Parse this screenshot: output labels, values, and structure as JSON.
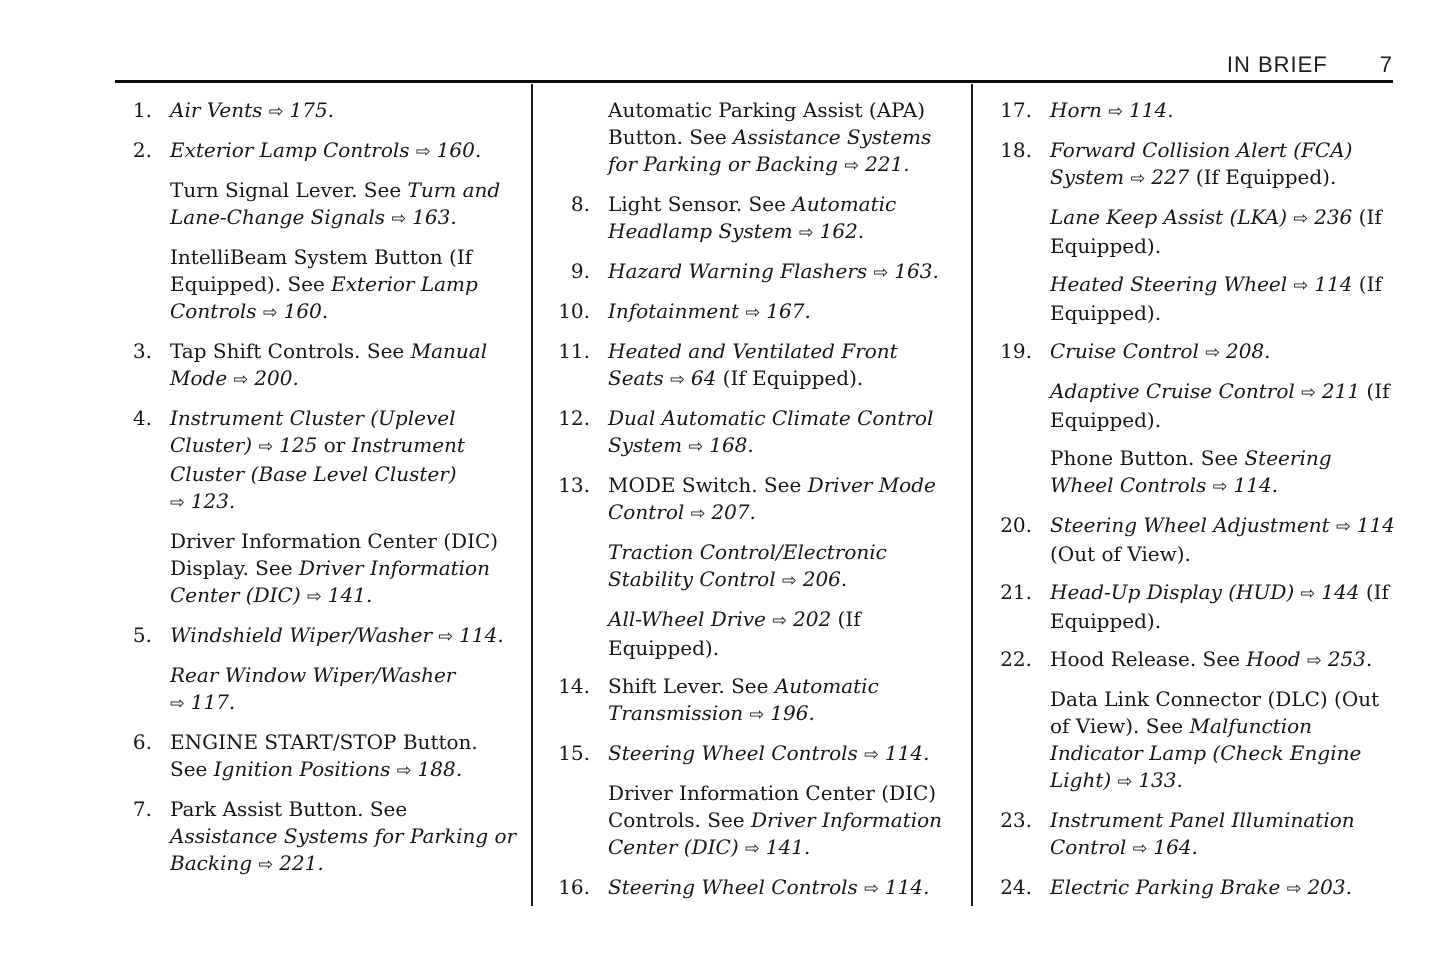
{
  "header": {
    "title": "IN BRIEF",
    "page_number": "7"
  },
  "symbols": {
    "arrow": "⇨"
  },
  "columns": [
    {
      "items": [
        {
          "number": "1.",
          "paragraphs": [
            {
              "runs": [
                {
                  "t": "Air Vents ",
                  "s": "i"
                },
                {
                  "ref": "175."
                }
              ]
            }
          ]
        },
        {
          "number": "2.",
          "paragraphs": [
            {
              "runs": [
                {
                  "t": "Exterior Lamp Controls ",
                  "s": "i"
                },
                {
                  "ref": "160."
                }
              ]
            },
            {
              "runs": [
                {
                  "t": "Turn Signal Lever. See ",
                  "s": "r"
                },
                {
                  "t": "Turn and Lane-Change Signals ",
                  "s": "i"
                },
                {
                  "ref": "163."
                }
              ]
            },
            {
              "runs": [
                {
                  "t": "IntelliBeam System Button (If Equipped). See ",
                  "s": "r"
                },
                {
                  "t": "Exterior Lamp Controls ",
                  "s": "i"
                },
                {
                  "ref": "160."
                }
              ]
            }
          ]
        },
        {
          "number": "3.",
          "paragraphs": [
            {
              "runs": [
                {
                  "t": "Tap Shift Controls. See ",
                  "s": "r"
                },
                {
                  "t": "Manual Mode ",
                  "s": "i"
                },
                {
                  "ref": "200."
                }
              ]
            }
          ]
        },
        {
          "number": "4.",
          "paragraphs": [
            {
              "runs": [
                {
                  "t": "Instrument Cluster (Uplevel Cluster) ",
                  "s": "i"
                },
                {
                  "ref": "125"
                },
                {
                  "t": " or ",
                  "s": "r"
                },
                {
                  "t": "Instrument Cluster (Base Level Cluster) ",
                  "s": "i"
                },
                {
                  "ref": "123."
                }
              ]
            },
            {
              "runs": [
                {
                  "t": "Driver Information Center (DIC) Display. See ",
                  "s": "r"
                },
                {
                  "t": "Driver Information Center (DIC) ",
                  "s": "i"
                },
                {
                  "ref": "141."
                }
              ]
            }
          ]
        },
        {
          "number": "5.",
          "paragraphs": [
            {
              "runs": [
                {
                  "t": "Windshield Wiper/Washer ",
                  "s": "i"
                },
                {
                  "ref": "114."
                }
              ]
            },
            {
              "runs": [
                {
                  "t": "Rear Window Wiper/Washer ",
                  "s": "i"
                },
                {
                  "ref": "117."
                }
              ]
            }
          ]
        },
        {
          "number": "6.",
          "paragraphs": [
            {
              "runs": [
                {
                  "t": "ENGINE START/STOP Button. See ",
                  "s": "r"
                },
                {
                  "t": "Ignition Positions ",
                  "s": "i"
                },
                {
                  "ref": "188."
                }
              ]
            }
          ]
        },
        {
          "number": "7.",
          "paragraphs": [
            {
              "runs": [
                {
                  "t": "Park Assist Button. See ",
                  "s": "r"
                },
                {
                  "t": "Assistance Systems for Parking or Backing ",
                  "s": "i"
                },
                {
                  "ref": "221."
                }
              ]
            }
          ]
        }
      ]
    },
    {
      "items": [
        {
          "number": null,
          "paragraphs": [
            {
              "runs": [
                {
                  "t": "Automatic Parking Assist (APA) Button. See ",
                  "s": "r"
                },
                {
                  "t": "Assistance Systems for Parking or Backing ",
                  "s": "i"
                },
                {
                  "ref": "221."
                }
              ]
            }
          ]
        },
        {
          "number": "8.",
          "paragraphs": [
            {
              "runs": [
                {
                  "t": "Light Sensor. See ",
                  "s": "r"
                },
                {
                  "t": "Automatic Headlamp System ",
                  "s": "i"
                },
                {
                  "ref": "162."
                }
              ]
            }
          ]
        },
        {
          "number": "9.",
          "paragraphs": [
            {
              "runs": [
                {
                  "t": "Hazard Warning Flashers ",
                  "s": "i"
                },
                {
                  "ref": "163."
                }
              ]
            }
          ]
        },
        {
          "number": "10.",
          "paragraphs": [
            {
              "runs": [
                {
                  "t": "Infotainment ",
                  "s": "i"
                },
                {
                  "ref": "167."
                }
              ]
            }
          ]
        },
        {
          "number": "11.",
          "paragraphs": [
            {
              "runs": [
                {
                  "t": "Heated and Ventilated Front Seats ",
                  "s": "i"
                },
                {
                  "ref": "64"
                },
                {
                  "t": " (If Equipped).",
                  "s": "r"
                }
              ]
            }
          ]
        },
        {
          "number": "12.",
          "paragraphs": [
            {
              "runs": [
                {
                  "t": "Dual Automatic Climate Control System ",
                  "s": "i"
                },
                {
                  "ref": "168."
                }
              ]
            }
          ]
        },
        {
          "number": "13.",
          "paragraphs": [
            {
              "runs": [
                {
                  "t": "MODE Switch. See ",
                  "s": "r"
                },
                {
                  "t": "Driver Mode Control ",
                  "s": "i"
                },
                {
                  "ref": "207."
                }
              ]
            },
            {
              "runs": [
                {
                  "t": "Traction Control/Electronic Stability Control ",
                  "s": "i"
                },
                {
                  "ref": "206."
                }
              ]
            },
            {
              "runs": [
                {
                  "t": "All-Wheel Drive ",
                  "s": "i"
                },
                {
                  "ref": "202"
                },
                {
                  "t": " (If Equipped).",
                  "s": "r"
                }
              ]
            }
          ]
        },
        {
          "number": "14.",
          "paragraphs": [
            {
              "runs": [
                {
                  "t": "Shift Lever. See ",
                  "s": "r"
                },
                {
                  "t": "Automatic Transmission ",
                  "s": "i"
                },
                {
                  "ref": "196."
                }
              ]
            }
          ]
        },
        {
          "number": "15.",
          "paragraphs": [
            {
              "runs": [
                {
                  "t": "Steering Wheel Controls ",
                  "s": "i"
                },
                {
                  "ref": "114."
                }
              ]
            },
            {
              "runs": [
                {
                  "t": "Driver Information Center (DIC) Controls. See ",
                  "s": "r"
                },
                {
                  "t": "Driver Information Center (DIC) ",
                  "s": "i"
                },
                {
                  "ref": "141."
                }
              ]
            }
          ]
        },
        {
          "number": "16.",
          "paragraphs": [
            {
              "runs": [
                {
                  "t": "Steering Wheel Controls ",
                  "s": "i"
                },
                {
                  "ref": "114."
                }
              ]
            }
          ]
        }
      ]
    },
    {
      "items": [
        {
          "number": "17.",
          "paragraphs": [
            {
              "runs": [
                {
                  "t": "Horn ",
                  "s": "i"
                },
                {
                  "ref": "114."
                }
              ]
            }
          ]
        },
        {
          "number": "18.",
          "paragraphs": [
            {
              "runs": [
                {
                  "t": "Forward Collision Alert (FCA) System ",
                  "s": "i"
                },
                {
                  "ref": "227"
                },
                {
                  "t": " (If Equipped).",
                  "s": "r"
                }
              ]
            },
            {
              "runs": [
                {
                  "t": "Lane Keep Assist (LKA) ",
                  "s": "i"
                },
                {
                  "ref": "236"
                },
                {
                  "t": " (If Equipped).",
                  "s": "r"
                }
              ]
            },
            {
              "runs": [
                {
                  "t": "Heated Steering Wheel ",
                  "s": "i"
                },
                {
                  "ref": "114"
                },
                {
                  "t": " (If Equipped).",
                  "s": "r"
                }
              ]
            }
          ]
        },
        {
          "number": "19.",
          "paragraphs": [
            {
              "runs": [
                {
                  "t": "Cruise Control ",
                  "s": "i"
                },
                {
                  "ref": "208."
                }
              ]
            },
            {
              "runs": [
                {
                  "t": "Adaptive Cruise Control ",
                  "s": "i"
                },
                {
                  "ref": "211"
                },
                {
                  "t": " (If Equipped).",
                  "s": "r"
                }
              ]
            },
            {
              "runs": [
                {
                  "t": "Phone Button. See ",
                  "s": "r"
                },
                {
                  "t": "Steering Wheel Controls ",
                  "s": "i"
                },
                {
                  "ref": "114."
                }
              ]
            }
          ]
        },
        {
          "number": "20.",
          "paragraphs": [
            {
              "runs": [
                {
                  "t": "Steering Wheel Adjustment ",
                  "s": "i"
                },
                {
                  "ref": "114"
                },
                {
                  "t": " (Out of View).",
                  "s": "r"
                }
              ]
            }
          ]
        },
        {
          "number": "21.",
          "paragraphs": [
            {
              "runs": [
                {
                  "t": "Head-Up Display (HUD) ",
                  "s": "i"
                },
                {
                  "ref": "144"
                },
                {
                  "t": " (If Equipped).",
                  "s": "r"
                }
              ]
            }
          ]
        },
        {
          "number": "22.",
          "paragraphs": [
            {
              "runs": [
                {
                  "t": "Hood Release. See ",
                  "s": "r"
                },
                {
                  "t": "Hood ",
                  "s": "i"
                },
                {
                  "ref": "253."
                }
              ]
            },
            {
              "runs": [
                {
                  "t": "Data Link Connector (DLC) (Out of View). See ",
                  "s": "r"
                },
                {
                  "t": "Malfunction Indicator Lamp (Check Engine Light) ",
                  "s": "i"
                },
                {
                  "ref": "133."
                }
              ]
            }
          ]
        },
        {
          "number": "23.",
          "paragraphs": [
            {
              "runs": [
                {
                  "t": "Instrument Panel Illumination Control ",
                  "s": "i"
                },
                {
                  "ref": "164."
                }
              ]
            }
          ]
        },
        {
          "number": "24.",
          "paragraphs": [
            {
              "runs": [
                {
                  "t": "Electric Parking Brake ",
                  "s": "i"
                },
                {
                  "ref": "203."
                }
              ]
            }
          ]
        }
      ]
    }
  ]
}
